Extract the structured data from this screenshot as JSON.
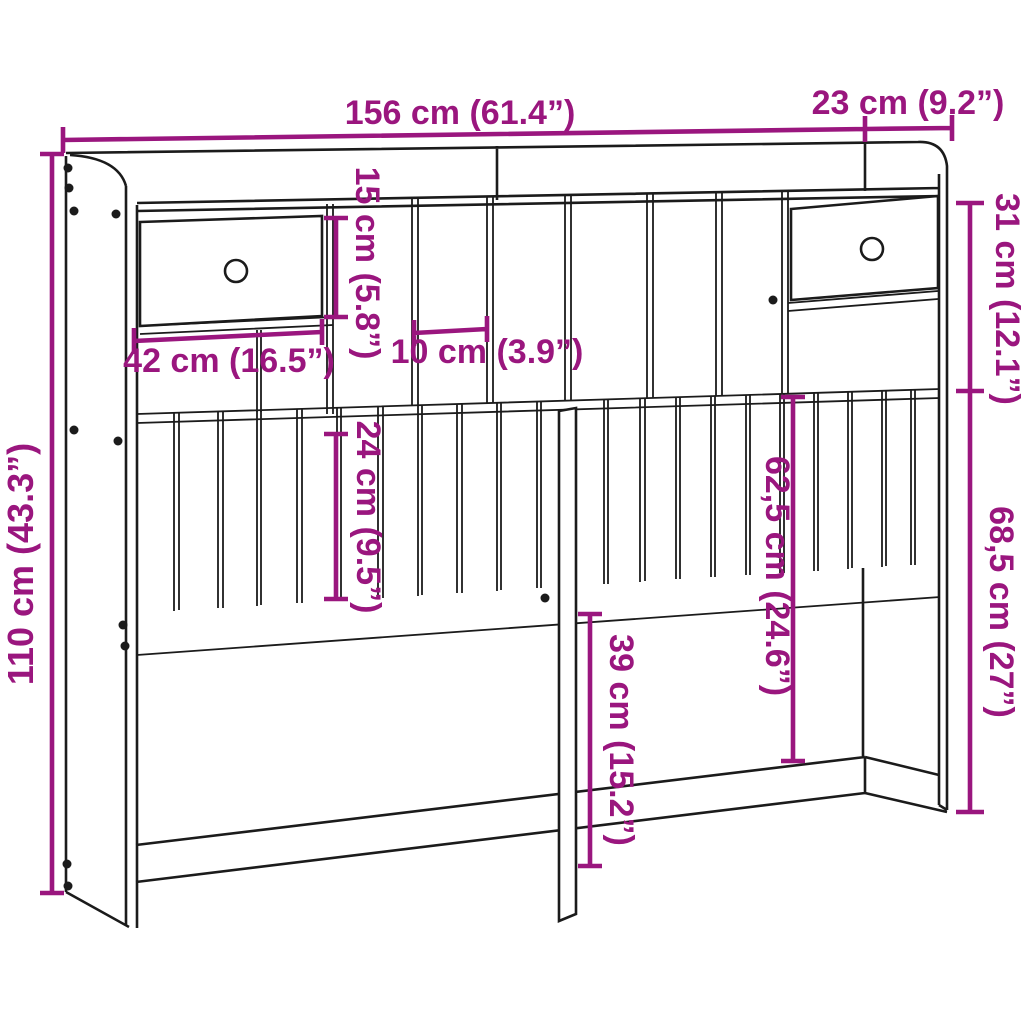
{
  "diagram": {
    "type": "furniture-dimension-drawing",
    "subject": "headboard cabinet with storage",
    "colors": {
      "dimension_accent": "#9A167E",
      "line_art": "#1b1b1b",
      "background": "#ffffff"
    },
    "labels": {
      "overall_width": "156 cm (61.4”)",
      "depth": "23 cm (9.2”)",
      "overall_height": "110 cm (43.3”)",
      "compartment_height": "15 cm (5.8”)",
      "drawer_width": "42 cm (16.5”)",
      "slot_width": "10 cm (3.9”)",
      "top_section_height": "31 cm (12.1”)",
      "slat_panel_height": "24 cm (9.5”)",
      "shelf_to_rail_height": "62,5 cm (24.6”)",
      "leg_clearance_height": "39 cm (15.2”)",
      "lower_section_height": "68,5 cm (27”)"
    }
  }
}
